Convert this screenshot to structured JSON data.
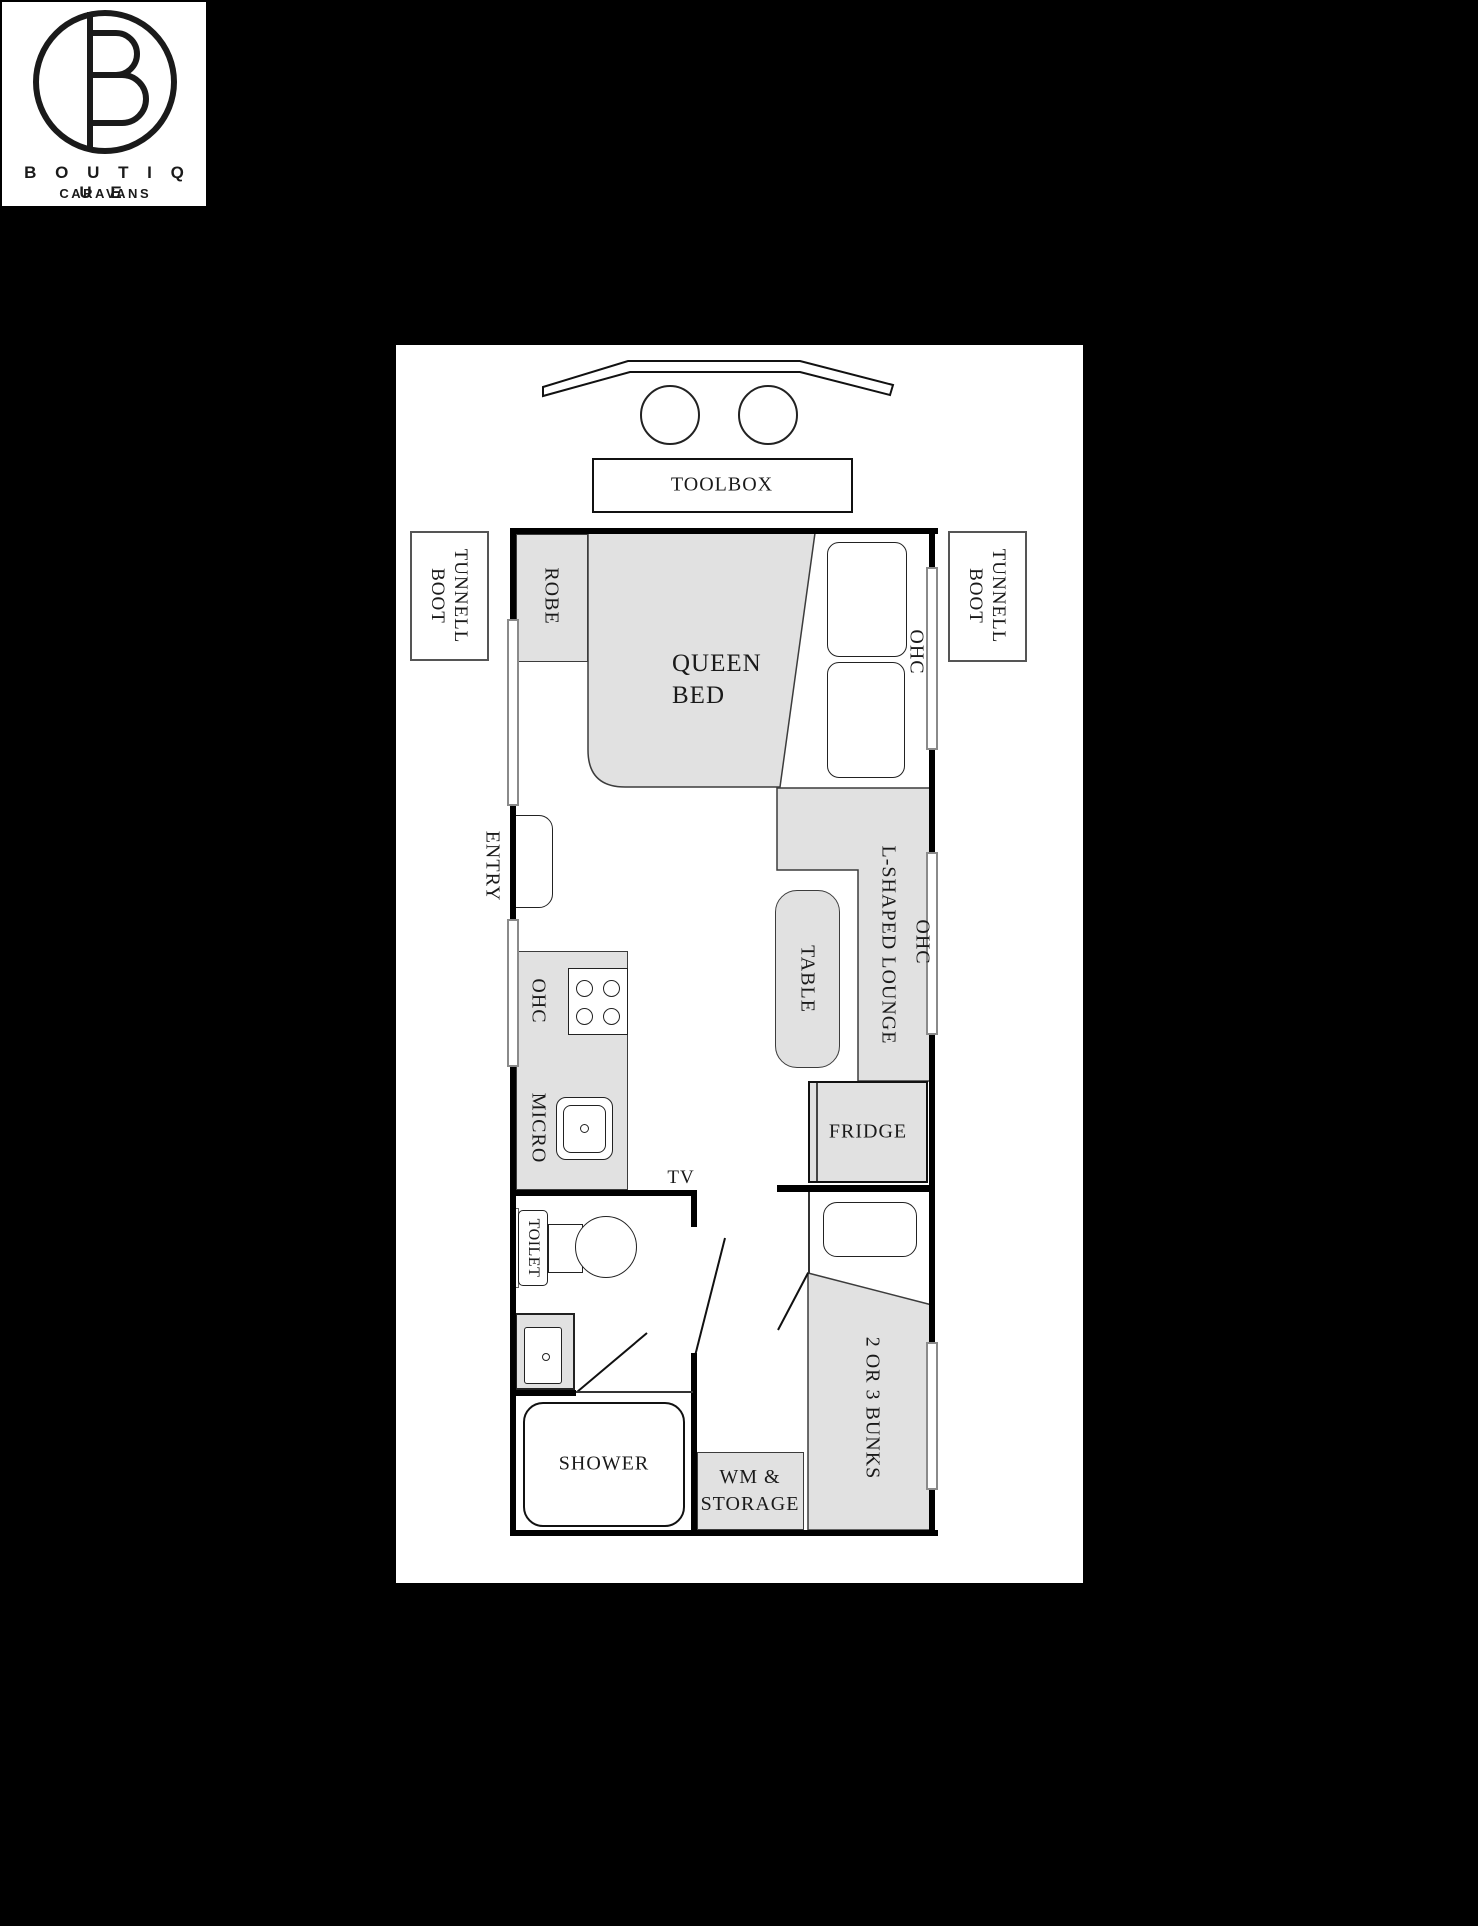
{
  "logo": {
    "brand": "B O U T I Q U E",
    "sub": "CARAVANS"
  },
  "plan": {
    "labels": {
      "toolbox": "TOOLBOX",
      "tunnel_boot_1": "TUNNELL",
      "tunnel_boot_2": "BOOT",
      "robe": "ROBE",
      "queen_bed_1": "QUEEN",
      "queen_bed_2": "BED",
      "ohc": "OHC",
      "entry": "ENTRY",
      "lounge": "L-SHAPED LOUNGE",
      "table": "TABLE",
      "fridge": "FRIDGE",
      "micro": "MICRO",
      "tv": "TV",
      "toilet": "TOILET",
      "shower": "SHOWER",
      "wm_storage_1": "WM &",
      "wm_storage_2": "STORAGE",
      "bunks": "2 OR 3 BUNKS"
    }
  },
  "colors": {
    "background": "#000000",
    "panel": "#ffffff",
    "fixture_fill": "#e1e1e1",
    "wall": "#000000",
    "window_border": "#8a8a8a",
    "line": "#333333",
    "text": "#1a1a1a"
  }
}
